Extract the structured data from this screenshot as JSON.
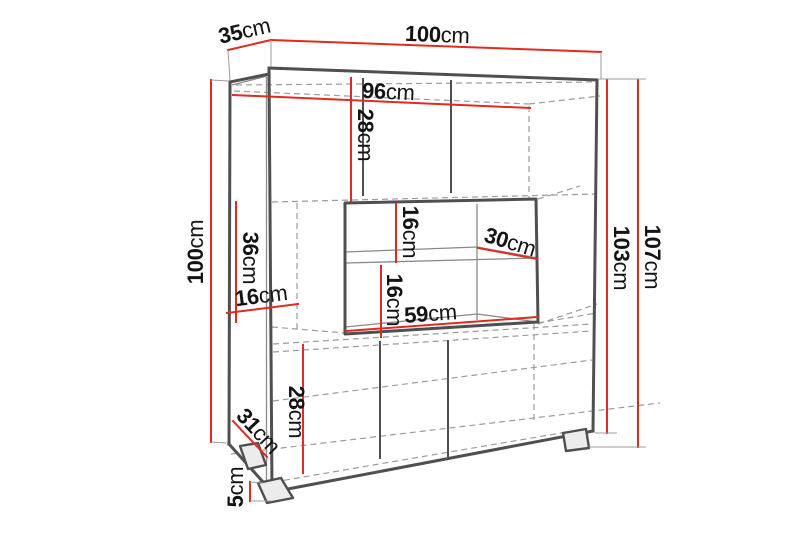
{
  "figure": {
    "kind": "furniture-dimension-diagram",
    "subject": "display cabinet with open middle niche and feet"
  },
  "colors": {
    "dimension": "#e02b20",
    "structure": "#8a8a8a",
    "structure_dark": "#4f4f4f",
    "hidden_edge": "#9c9c9c",
    "background": "#ffffff",
    "text": "#141414"
  },
  "dimensions": {
    "top_depth": {
      "value": "35",
      "unit": "cm"
    },
    "top_width": {
      "value": "100",
      "unit": "cm"
    },
    "interior_width": {
      "value": "96",
      "unit": "cm"
    },
    "upper_section_height": {
      "value": "28",
      "unit": "cm"
    },
    "left_side_height": {
      "value": "100",
      "unit": "cm"
    },
    "middle_section_height": {
      "value": "36",
      "unit": "cm"
    },
    "left_shelf_depth": {
      "value": "16",
      "unit": "cm"
    },
    "niche_upper_gap": {
      "value": "16",
      "unit": "cm"
    },
    "niche_lower_gap": {
      "value": "16",
      "unit": "cm"
    },
    "niche_shelf_depth": {
      "value": "30",
      "unit": "cm"
    },
    "niche_width": {
      "value": "59",
      "unit": "cm"
    },
    "lower_section_height": {
      "value": "28",
      "unit": "cm"
    },
    "base_depth": {
      "value": "31",
      "unit": "cm"
    },
    "foot_height": {
      "value": "5",
      "unit": "cm"
    },
    "body_height": {
      "value": "103",
      "unit": "cm"
    },
    "total_height": {
      "value": "107",
      "unit": "cm"
    }
  }
}
